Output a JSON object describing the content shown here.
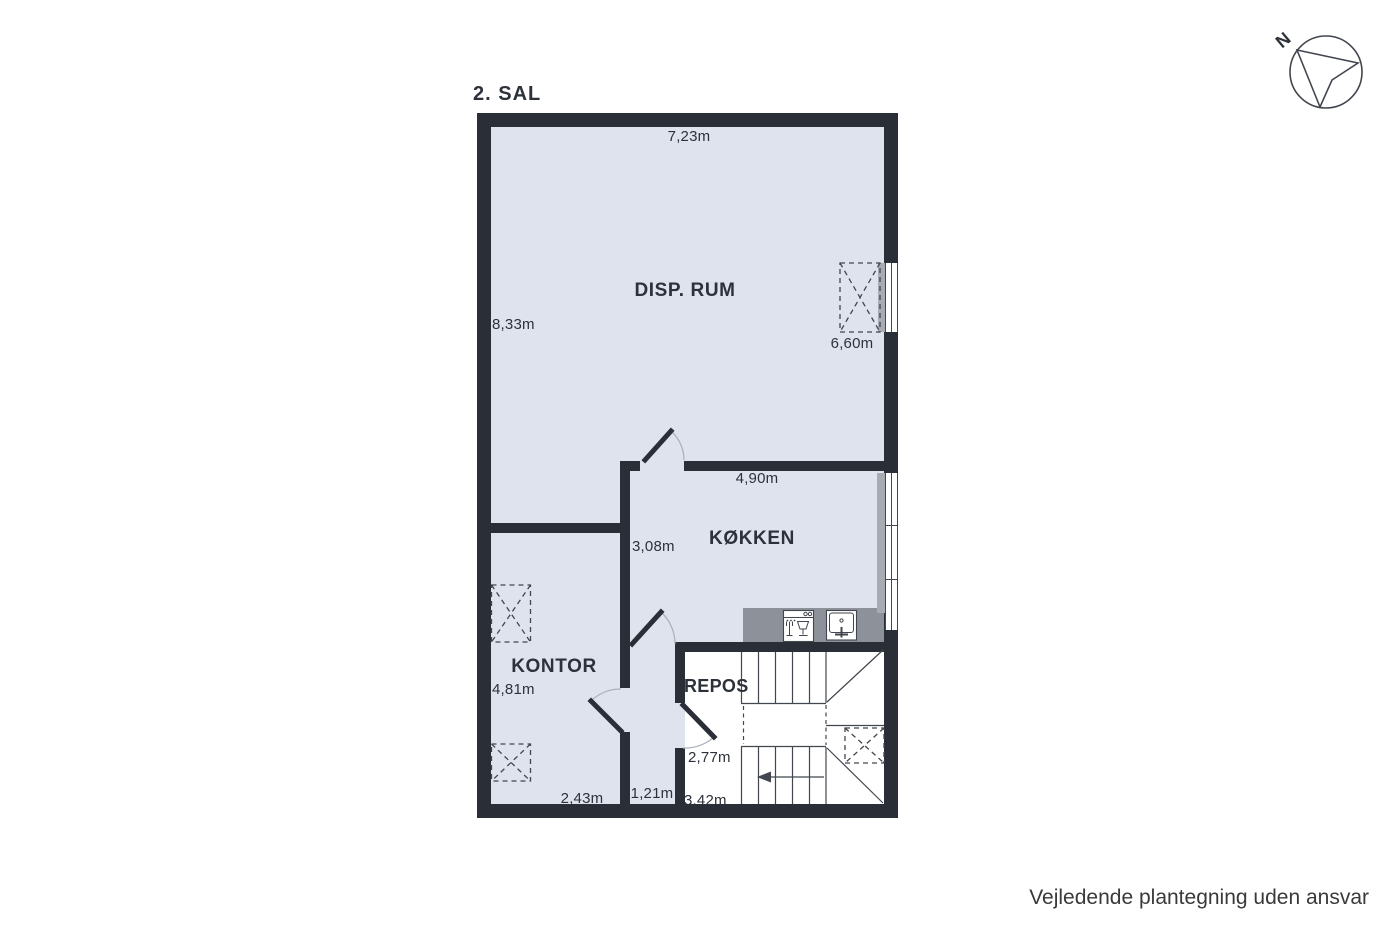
{
  "plan": {
    "title": "2. SAL",
    "rooms": {
      "disp_rum": {
        "label": "DISP. RUM",
        "dims": {
          "top": "7,23m",
          "left": "8,33m",
          "right": "6,60m"
        }
      },
      "kokken": {
        "label": "KØKKEN",
        "dims": {
          "top": "4,90m",
          "left": "3,08m"
        }
      },
      "kontor": {
        "label": "KONTOR",
        "dims": {
          "left": "4,81m",
          "bottom": "2,43m"
        }
      },
      "hall": {
        "dims": {
          "bottom": "1,21m"
        }
      },
      "repos": {
        "label": "REPOS",
        "dims": {
          "left": "2,77m",
          "bottom": "3,42m"
        }
      }
    },
    "compass": {
      "label": "N"
    },
    "disclaimer": "Vejledende plantegning uden ansvar"
  },
  "icons": [
    "compass-north-icon",
    "dishwasher-icon",
    "sink-icon",
    "roof-window-icon",
    "stairs-direction-arrow-icon"
  ],
  "colors": {
    "wall": "#2a2e37",
    "room": "#dfe3ee",
    "floorwhite": "#ffffff",
    "counter": "#8d9199",
    "sill": "#a8abb1",
    "line": "#42464e",
    "text": "#2c313a",
    "arc": "#a9afb8",
    "footer": "#3a3a3a"
  }
}
